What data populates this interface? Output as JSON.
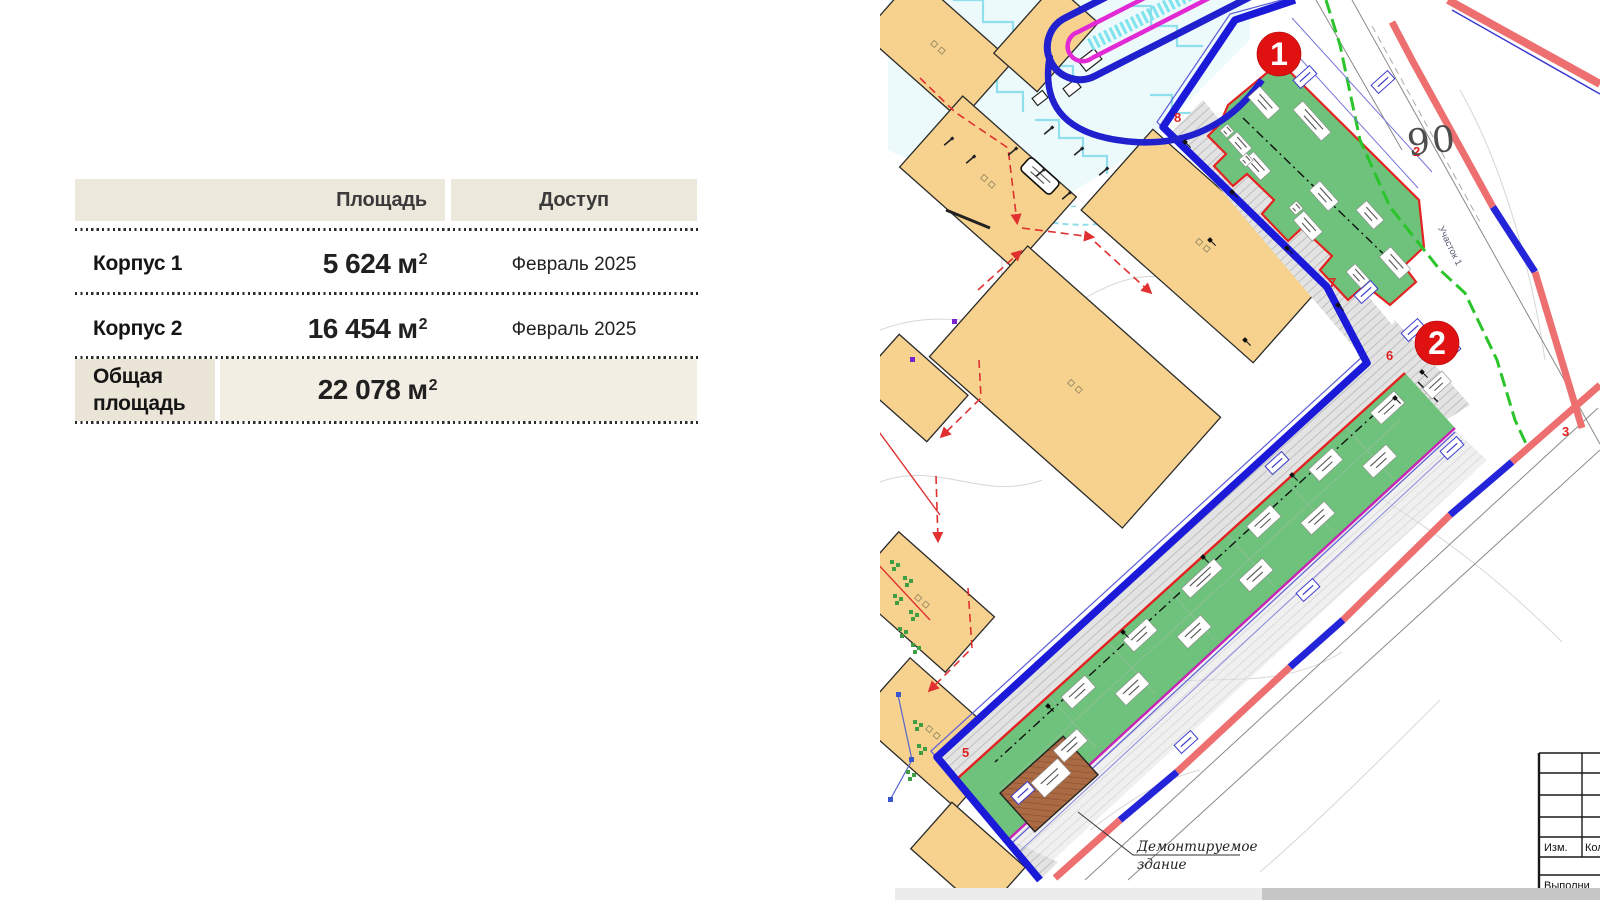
{
  "left_panel": {
    "table": {
      "headers": {
        "area": "Площадь",
        "access": "Доступ"
      },
      "rows": [
        {
          "name": "Корпус 1",
          "area_number": "5 624",
          "area_unit": "м",
          "area_power": "2",
          "access": "Февраль 2025"
        },
        {
          "name": "Корпус 2",
          "area_number": "16 454",
          "area_unit": "м",
          "area_power": "2",
          "access": "Февраль 2025"
        },
        {
          "name": "Общая площадь",
          "area_number": "22 078",
          "area_unit": "м",
          "area_power": "2",
          "access": ""
        }
      ]
    }
  },
  "map": {
    "markers": [
      {
        "label": "1"
      },
      {
        "label": "2"
      }
    ],
    "plot_number": "90",
    "red_points": {
      "p2": "2",
      "p3": "3",
      "p5": "5",
      "p6": "6",
      "p7": "7",
      "p8": "8"
    },
    "site_label": "Участок 1",
    "demolition_note_line1": "Демонтируемое",
    "demolition_note_line2": "здание",
    "title_block": {
      "izm": "Изм.",
      "kol": "Кол",
      "vypolnil": "Выполни"
    },
    "colors": {
      "boundary_blue": "#1a1ad8",
      "street_red": "#ee6f6f",
      "parcel_outline_red": "#e42222",
      "parcel_green": "#6ec27b",
      "existing_building_tan": "#f6d28e",
      "demolished_brown": "#aa6a44",
      "utility_magenta": "#c921b5",
      "utility_green": "#2bc42b",
      "marker_red": "#e01111"
    }
  }
}
